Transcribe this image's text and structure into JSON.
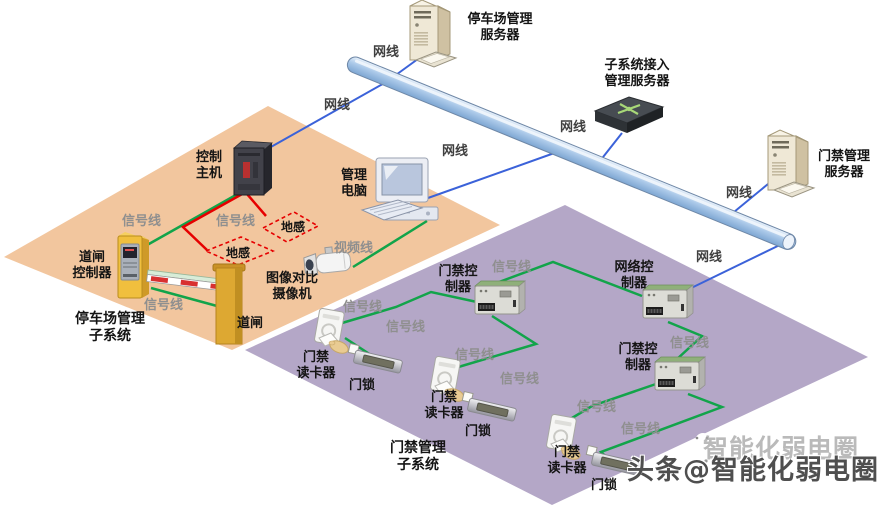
{
  "zones": {
    "parking": {
      "line1": "停车场管理",
      "line2": "子系统",
      "color": "#f2c69e"
    },
    "access": {
      "line1": "门禁管理",
      "line2": "子系统",
      "color": "#b4a7c7"
    }
  },
  "devices": {
    "parking_server": {
      "line1": "停车场管理",
      "line2": "服务器"
    },
    "subsystem_server": {
      "line1": "子系统接入",
      "line2": "管理服务器"
    },
    "access_server": {
      "line1": "门禁管理",
      "line2": "服务器"
    },
    "control_host": {
      "line1": "控制",
      "line2": "主机"
    },
    "management_pc": {
      "line1": "管理",
      "line2": "电脑"
    },
    "barrier_controller": {
      "line1": "道闸",
      "line2": "控制器"
    },
    "barrier_gate": {
      "line1": "道闸"
    },
    "camera": {
      "line1": "图像对比",
      "line2": "摄像机"
    },
    "ground_loop": {
      "line1": "地感"
    },
    "access_controller": {
      "line1": "门禁控",
      "line2": "制器"
    },
    "network_controller": {
      "line1": "网络控",
      "line2": "制器"
    },
    "card_reader": {
      "line1": "门禁",
      "line2": "读卡器"
    },
    "door_lock": {
      "line1": "门锁"
    }
  },
  "wires": {
    "network": "网线",
    "signal": "信号线",
    "video": "视频线"
  },
  "watermark": {
    "ghost": "智能化弱电圈",
    "main": "头条@智能化弱电圈"
  },
  "colors": {
    "network_line": "#3b62d9",
    "signal_line": "#12a44a",
    "ground_loop_line": "#e60000",
    "backbone_fill": "#abc9e9",
    "parking_zone": "#f2c69e",
    "access_zone": "#b4a7c7"
  }
}
